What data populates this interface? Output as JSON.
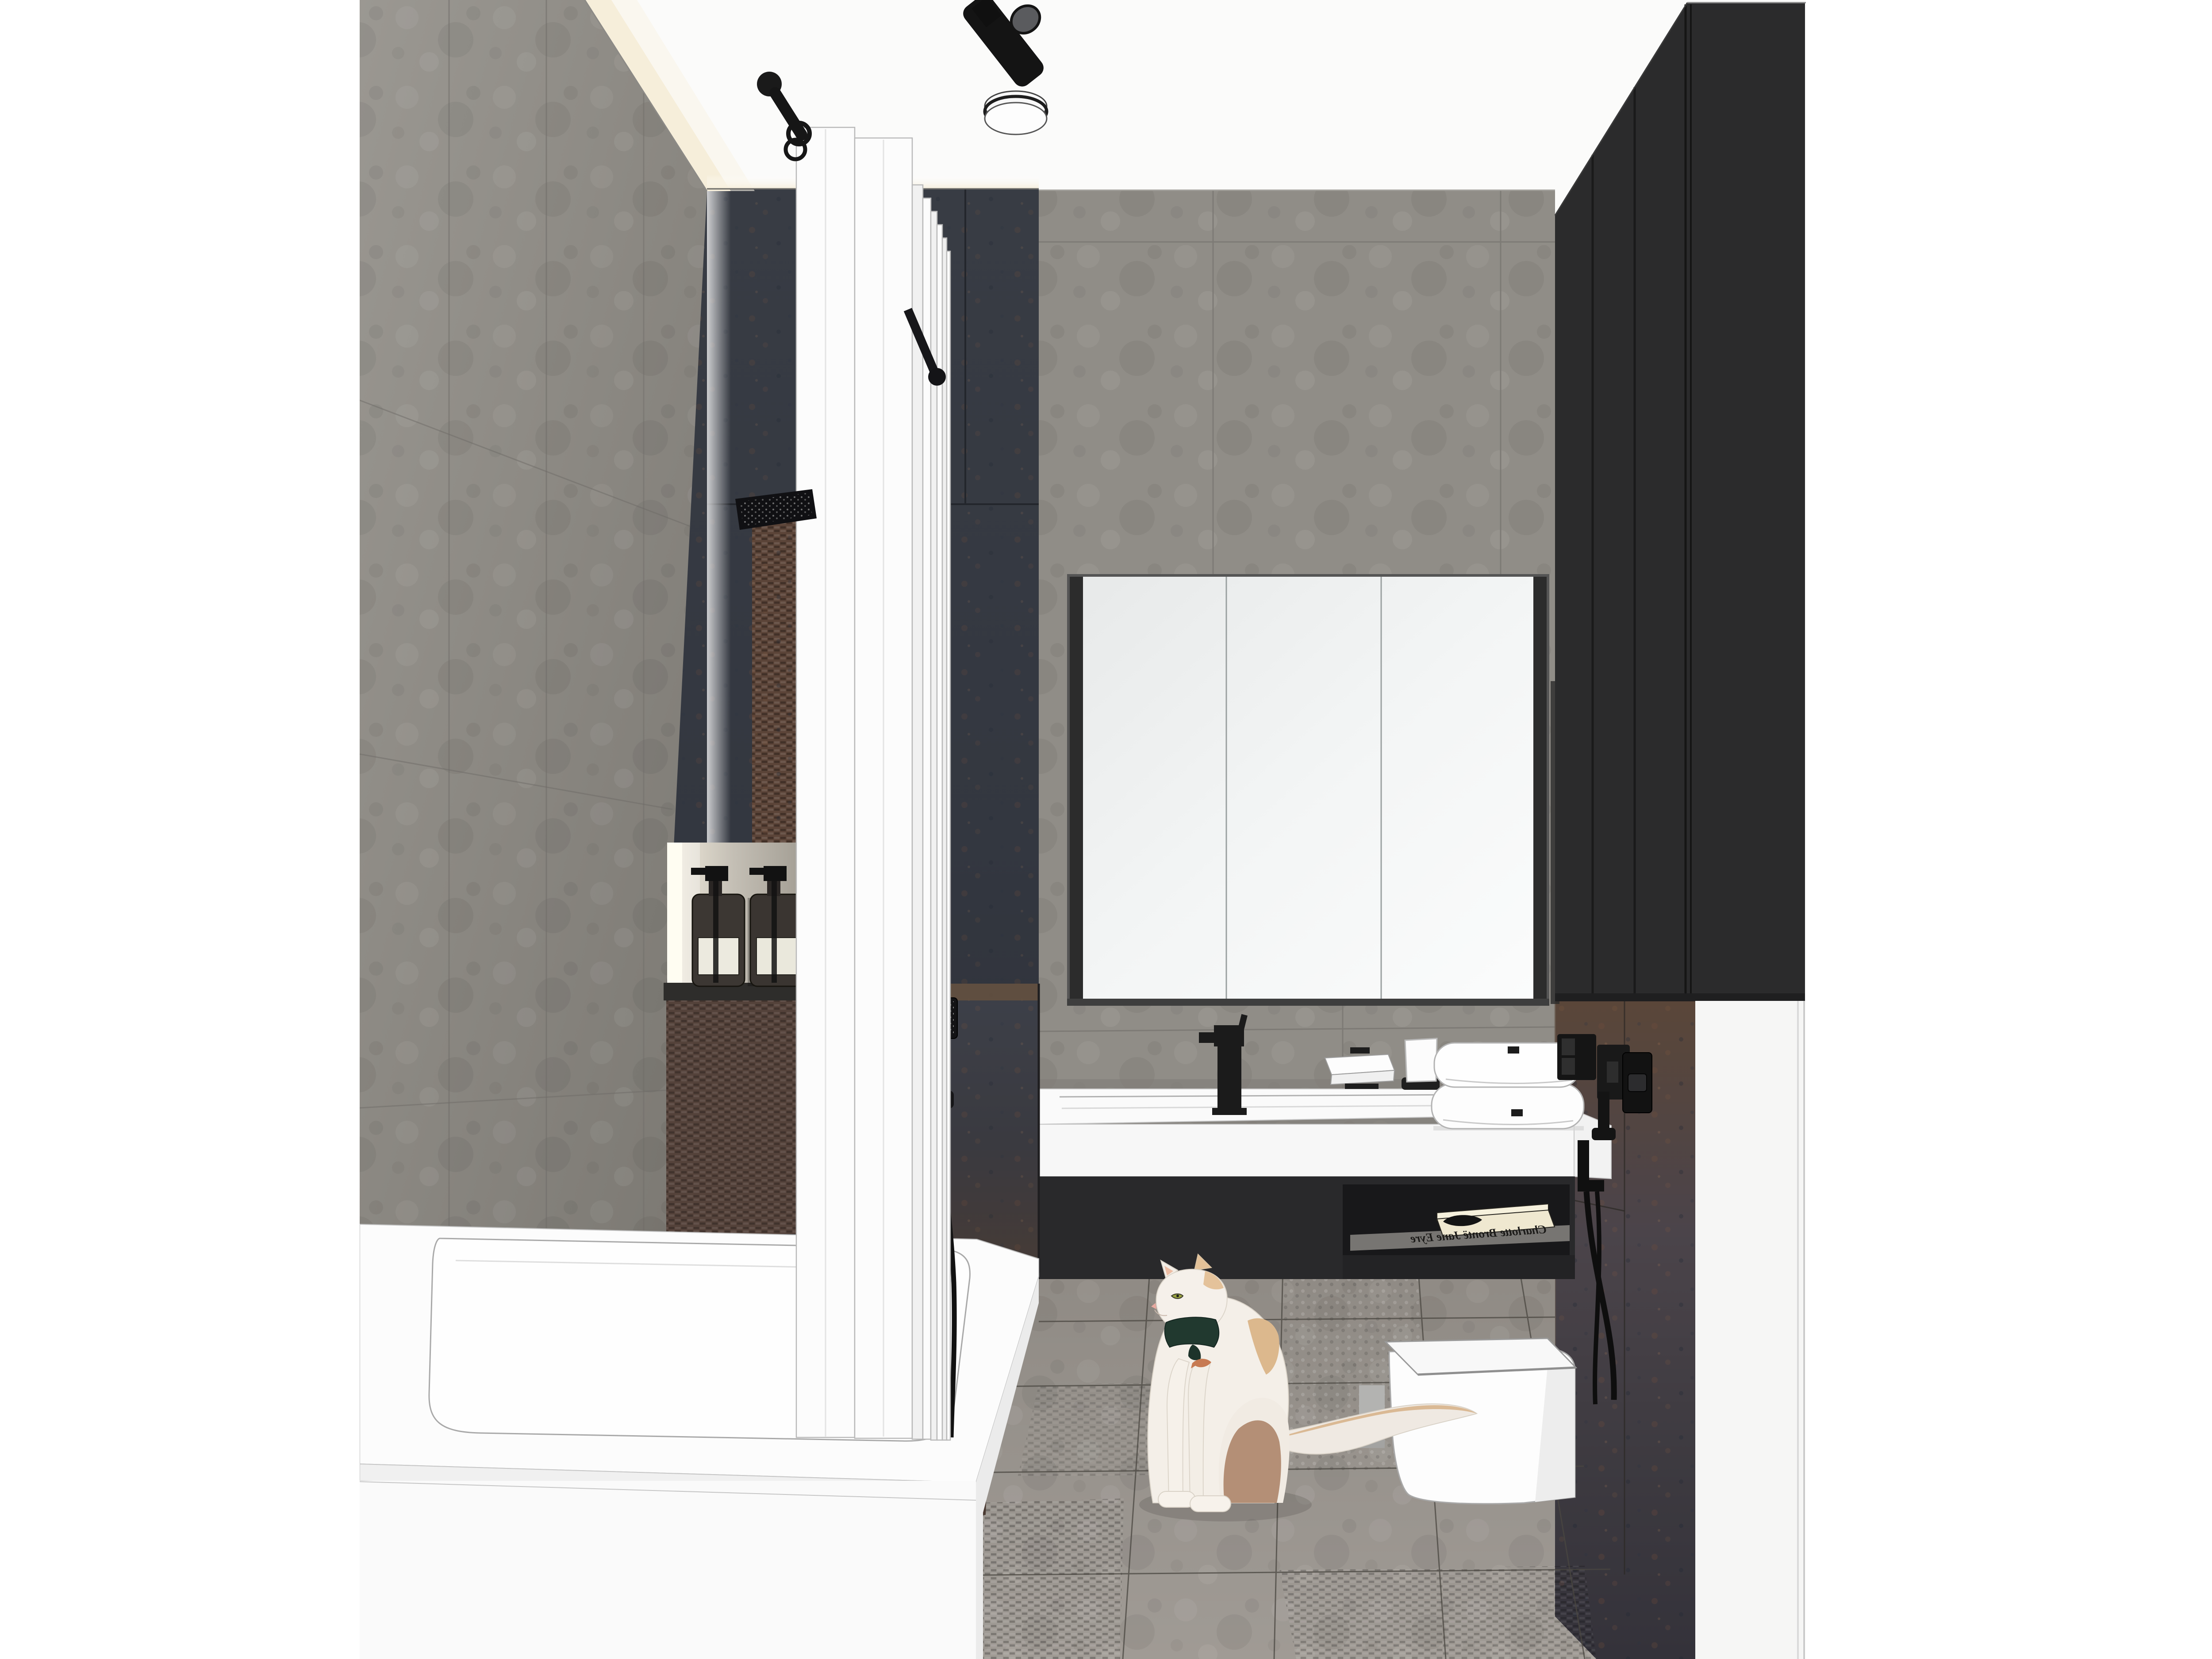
{
  "scene": {
    "type": "architectural interior rendering",
    "room": "bathroom",
    "description": "Small modern bathroom visualization: gray concrete-look tile, dark oxidized metal tile, black fixtures, white sanitary ware, white folding bath screen, black tall cabinet, and a white long-haired cat sitting on the tiled floor"
  },
  "ceiling": {
    "spotlight": "black angled track spotlight",
    "flush_light": "round white drum ceiling light with black band",
    "screen_support": "black ceiling rod with round knob and rings"
  },
  "shower": {
    "screen": "white accordion folding bath screen",
    "rain_head": "black square rain shower head on black arm",
    "mosaic_strip": "rust woven mosaic tile band",
    "niche": {
      "led_strip": "warm white LED edge light",
      "shelf": "dark stone shelf",
      "dispenser_count": 2,
      "dispensers": "amber glass pump bottles with white labels and black pumps"
    }
  },
  "vanity": {
    "mirror_doors": 3,
    "counter": "white trough sink with deck-mounted black square mixer",
    "soap_dish": "white wall-mounted soap dish on black bracket",
    "tumbler": "white cup in black wall ring",
    "towel_count": 2,
    "towels": "white folded towels with small black tags",
    "book_title": "Charlotte Brontë Jane Eyre",
    "book_note": "book text appears mirrored in the rendering",
    "under_shelf": "open black niche below sink"
  },
  "toilet": {
    "type": "white wall-hung square toilet",
    "flush_plate": "black square flush plate",
    "bidet_sprayer": "black hygienic sprayer with hoses",
    "sockets": "black double electrical outlet"
  },
  "bathtub": "white built-in bathtub with front apron panel",
  "cat": {
    "fur": "white with cream and tan patches",
    "eye_color": "green",
    "accessory": "dark green neckerchief with small copper fish charm",
    "pose": "sitting on floor, looking up toward the vanity"
  },
  "tall_cabinet": "matte black wardrobe with vertical panel seams, upper right",
  "palette": {
    "page_white": "#ffffff",
    "ceiling_white": "#f9f9f8",
    "wall_gray": "#908d87",
    "wall_gray_dark": "#7c7974",
    "tile_dark_blue": "#363a41",
    "tile_rust": "#5a4336",
    "cove_light": "#f6eeda",
    "cabinet_black": "#2b2b2c",
    "fixture_black": "#161616",
    "ceramic_white": "#fbfbfb",
    "floor_gray": "#97928c",
    "grout_dark": "#4a4741",
    "book_cream": "#efe8d0",
    "cat_white": "#f4efe8",
    "cat_tan": "#dcb88d",
    "bandana_green": "#21392f",
    "eye_green": "#97a03f"
  }
}
